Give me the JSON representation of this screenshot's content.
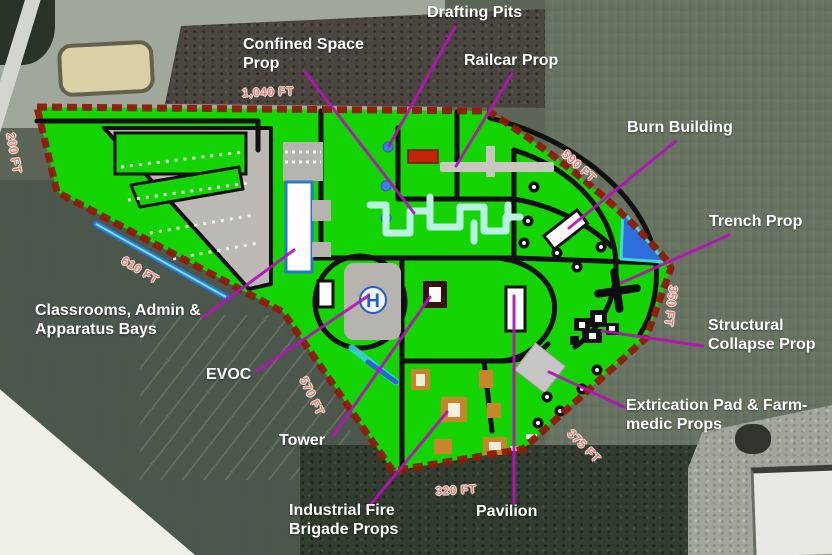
{
  "map": {
    "type": "fire-training-facility-site-plan-over-aerial-photo",
    "helipad_symbol": "H",
    "annotations": [
      {
        "name": "confined-space-prop",
        "text": "Confined Space\nProp",
        "x": 243,
        "y": 36,
        "line": [
          305,
          72,
          414,
          213
        ]
      },
      {
        "name": "drafting-pits",
        "text": "Drafting Pits",
        "x": 427,
        "y": 4,
        "line": [
          455,
          27,
          389,
          146
        ]
      },
      {
        "name": "railcar-prop",
        "text": "Railcar Prop",
        "x": 464,
        "y": 52,
        "line": [
          512,
          74,
          456,
          166
        ]
      },
      {
        "name": "burn-building",
        "text": "Burn Building",
        "x": 627,
        "y": 119,
        "line": [
          676,
          141,
          569,
          228
        ]
      },
      {
        "name": "trench-prop",
        "text": "Trench Prop",
        "x": 709,
        "y": 213,
        "line": [
          729,
          235,
          621,
          283
        ]
      },
      {
        "name": "structural-collapse-prop",
        "text": "Structural\nCollapse Prop",
        "x": 708,
        "y": 317,
        "line": [
          703,
          346,
          602,
          331
        ]
      },
      {
        "name": "extrication-pad-farm-medic-props",
        "text": "Extrication Pad & Farm-\nmedic Props",
        "x": 626,
        "y": 397,
        "line": [
          624,
          407,
          549,
          372
        ]
      },
      {
        "name": "pavilion",
        "text": "Pavilion",
        "x": 476,
        "y": 503,
        "line": [
          514,
          503,
          514,
          296
        ]
      },
      {
        "name": "industrial-fire-brigade-props",
        "text": "Industrial Fire\nBrigade Props",
        "x": 289,
        "y": 502,
        "line": [
          367,
          509,
          447,
          412
        ]
      },
      {
        "name": "tower",
        "text": "Tower",
        "x": 279,
        "y": 432,
        "line": [
          333,
          436,
          430,
          297
        ]
      },
      {
        "name": "evoc",
        "text": "EVOC",
        "x": 206,
        "y": 366,
        "line": [
          257,
          371,
          368,
          296
        ]
      },
      {
        "name": "classrooms-admin-apparatus-bays",
        "text": "Classrooms, Admin &\nApparatus Bays",
        "x": 35,
        "y": 302,
        "line": [
          203,
          317,
          294,
          250
        ]
      }
    ],
    "distances": [
      {
        "name": "dist-1040-ft",
        "text": "1,040 FT",
        "x": 268,
        "y": 92,
        "rot": -2
      },
      {
        "name": "dist-200-ft",
        "text": "200 FT",
        "x": 14,
        "y": 153,
        "rot": 80
      },
      {
        "name": "dist-610-ft",
        "text": "610 FT",
        "x": 140,
        "y": 270,
        "rot": 31
      },
      {
        "name": "dist-590-ft",
        "text": "590 FT",
        "x": 579,
        "y": 166,
        "rot": 42
      },
      {
        "name": "dist-350-ft",
        "text": "350 FT",
        "x": 671,
        "y": 306,
        "rot": 97
      },
      {
        "name": "dist-375-ft",
        "text": "375 FT",
        "x": 584,
        "y": 446,
        "rot": 45
      },
      {
        "name": "dist-320-ft",
        "text": "320 FT",
        "x": 456,
        "y": 490,
        "rot": -3
      },
      {
        "name": "dist-570-ft",
        "text": "570 FT",
        "x": 312,
        "y": 396,
        "rot": 64
      }
    ],
    "colors": {
      "site_green": "#14d403",
      "boundary_red": "#8f1a08",
      "road_black": "#101010",
      "leader_magenta": "#b512b8",
      "distance_pink": "#e87b6e",
      "label_white": "#ffffff",
      "water_blue": "#2e6ede",
      "prop_cyan": "#b9f2e2",
      "prop_orange": "#c8862c",
      "pad_gray": "#b7b3ae"
    }
  }
}
